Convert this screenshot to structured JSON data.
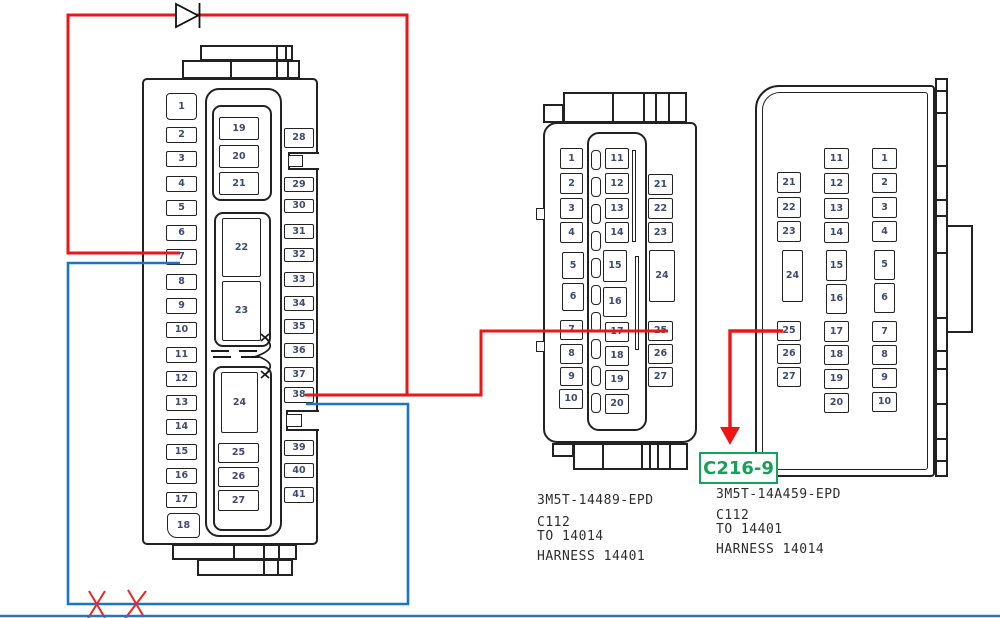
{
  "connector_left": {
    "left_pins": [
      "1",
      "2",
      "3",
      "4",
      "5",
      "6",
      "7",
      "8",
      "9",
      "10",
      "11",
      "12",
      "13",
      "14",
      "15",
      "16",
      "17",
      "18"
    ],
    "middle_pins": [
      "19",
      "20",
      "21",
      "22",
      "23",
      "24",
      "25",
      "26",
      "27"
    ],
    "right_pins": [
      "28",
      "29",
      "30",
      "31",
      "32",
      "33",
      "34",
      "35",
      "36",
      "37",
      "38",
      "39",
      "40",
      "41"
    ]
  },
  "connector_middle": {
    "left_pins": [
      "1",
      "2",
      "3",
      "4",
      "5",
      "6",
      "7",
      "8",
      "9",
      "10"
    ],
    "middle_pins": [
      "11",
      "12",
      "13",
      "14",
      "15",
      "16",
      "17",
      "18",
      "19",
      "20"
    ],
    "right_pins": [
      "21",
      "22",
      "23",
      "24",
      "25",
      "26",
      "27"
    ],
    "labels": {
      "part_number": "3M5T-14489-EPD",
      "connector_id": "C112",
      "to": "TO 14014",
      "harness": "HARNESS 14401"
    }
  },
  "connector_right": {
    "left_pins": [
      "21",
      "22",
      "23",
      "24",
      "25",
      "26",
      "27"
    ],
    "middle_pins": [
      "11",
      "12",
      "13",
      "14",
      "15",
      "16",
      "17",
      "18",
      "19",
      "20"
    ],
    "right_pins": [
      "1",
      "2",
      "3",
      "4",
      "5",
      "6",
      "7",
      "8",
      "9",
      "10"
    ],
    "labels": {
      "part_number": "3M5T-14A459-EPD",
      "connector_id": "C112",
      "to": "TO 14401",
      "harness": "HARNESS 14014"
    },
    "callout": "C216-9"
  },
  "wires": [
    {
      "color": "red",
      "through": "diode",
      "pins": [
        "7",
        "38",
        "25"
      ],
      "arrow_to": "C216-9"
    },
    {
      "color": "blue",
      "pins": [
        "7",
        "38"
      ],
      "crossed_out": true
    }
  ],
  "colors": {
    "wire_red": "#ef1515",
    "wire_blue": "#1b74cc",
    "callout_green": "#14a35a",
    "pin_number": "#3e4a70",
    "outline": "#222222"
  }
}
